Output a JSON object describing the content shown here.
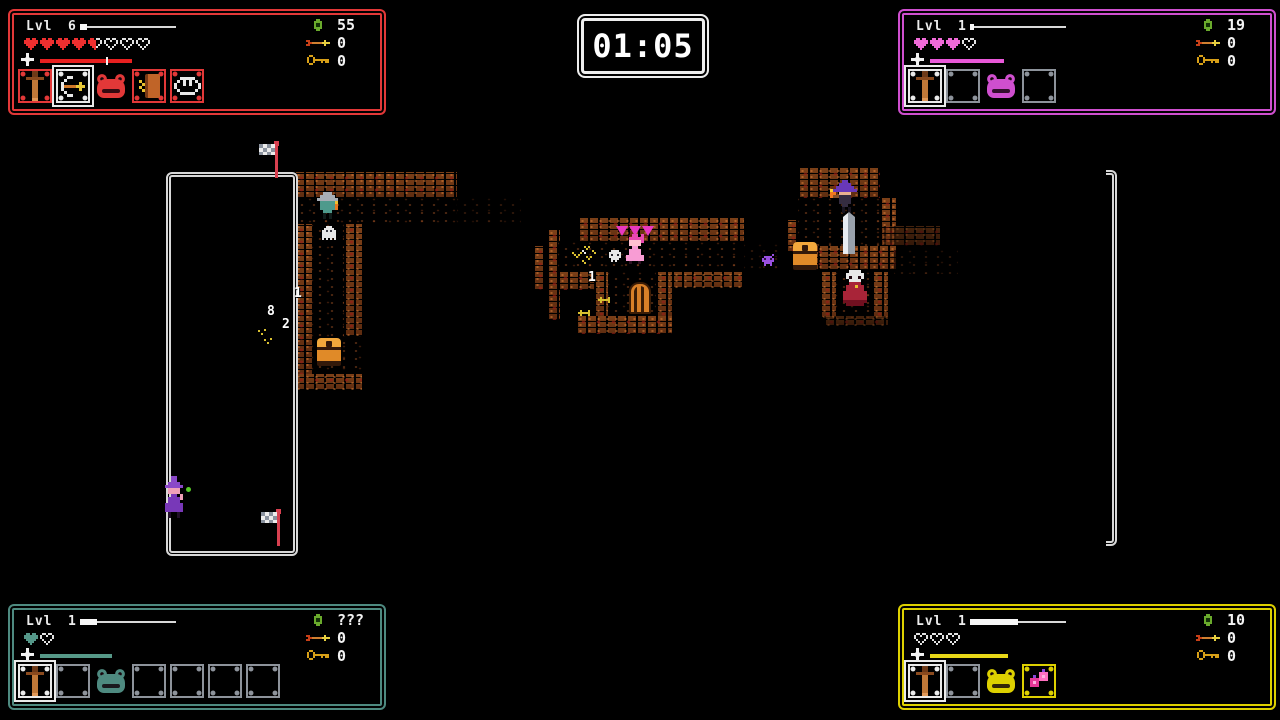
{
  "timer": {
    "value": "01:05"
  },
  "players": [
    {
      "position": "top-left",
      "colors": {
        "accent": "#e23838",
        "heart": "#ee2f2f",
        "bar": "#e82020"
      },
      "level_label": "Lvl",
      "level": "6",
      "xp_fill": 0.07,
      "hearts": [
        "full",
        "full",
        "full",
        "full",
        "half",
        "empty",
        "empty",
        "empty"
      ],
      "special": {
        "width": 92,
        "tick": 0.72
      },
      "counters": {
        "gems": "55",
        "arrows": "0",
        "keys": "0"
      },
      "slots": [
        {
          "item": "sword",
          "frame": "accent"
        },
        {
          "item": "bow",
          "frame": "selected"
        },
        {
          "item": "slime"
        },
        {
          "item": "book",
          "frame": "accent"
        },
        {
          "item": "fangs",
          "frame": "accent"
        }
      ]
    },
    {
      "position": "top-right",
      "colors": {
        "accent": "#cf4fcf",
        "heart": "#f06ad8",
        "bar": "#e858d8"
      },
      "level_label": "Lvl",
      "level": "1",
      "xp_fill": 0.02,
      "hearts": [
        "full",
        "full",
        "full",
        "empty"
      ],
      "special": {
        "width": 74,
        "tick": null
      },
      "counters": {
        "gems": "19",
        "arrows": "0",
        "keys": "0"
      },
      "slots": [
        {
          "item": "sword",
          "frame": "selected"
        },
        {
          "item": "none",
          "frame": "empty"
        },
        {
          "item": "slime"
        },
        {
          "item": "none",
          "frame": "empty"
        }
      ]
    },
    {
      "position": "bottom-left",
      "colors": {
        "accent": "#4e8a80",
        "heart": "#56988a",
        "bar": "#569888"
      },
      "level_label": "Lvl",
      "level": "1",
      "xp_fill": 0.18,
      "hearts": [
        "full",
        "empty"
      ],
      "special": {
        "width": 72,
        "tick": null
      },
      "counters": {
        "gems": "???",
        "arrows": "0",
        "keys": "0"
      },
      "slots": [
        {
          "item": "sword",
          "frame": "selected"
        },
        {
          "item": "none",
          "frame": "empty"
        },
        {
          "item": "slime"
        },
        {
          "item": "none",
          "frame": "empty"
        },
        {
          "item": "none",
          "frame": "empty"
        },
        {
          "item": "none",
          "frame": "empty"
        },
        {
          "item": "none",
          "frame": "empty"
        }
      ]
    },
    {
      "position": "bottom-right",
      "colors": {
        "accent": "#ddd000",
        "heart": "#e2e2e2",
        "bar": "#e8d818"
      },
      "level_label": "Lvl",
      "level": "1",
      "xp_fill": 0.5,
      "hearts": [
        "empty",
        "empty",
        "empty"
      ],
      "special": {
        "width": 78,
        "tick": null
      },
      "counters": {
        "gems": "10",
        "arrows": "0",
        "keys": "0"
      },
      "slots": [
        {
          "item": "sword",
          "frame": "selected"
        },
        {
          "item": "none",
          "frame": "empty"
        },
        {
          "item": "slime"
        },
        {
          "item": "berries",
          "frame": "accent"
        }
      ]
    }
  ],
  "map": {
    "room": {
      "x": 166,
      "y": 172,
      "w": 122,
      "h": 374
    },
    "right_wall": {
      "x": 1106,
      "y": 170,
      "w": 11,
      "h": 376
    },
    "tiles": [
      {
        "k": "brick",
        "x": 294,
        "y": 172,
        "w": 163,
        "h": 26
      },
      {
        "k": "floor",
        "x": 294,
        "y": 198,
        "w": 163,
        "h": 26
      },
      {
        "k": "floor2",
        "x": 457,
        "y": 198,
        "w": 64,
        "h": 26
      },
      {
        "k": "brick",
        "x": 294,
        "y": 224,
        "w": 18,
        "h": 152
      },
      {
        "k": "floor",
        "x": 312,
        "y": 224,
        "w": 50,
        "h": 150
      },
      {
        "k": "brick",
        "x": 344,
        "y": 224,
        "w": 18,
        "h": 112
      },
      {
        "k": "brick",
        "x": 294,
        "y": 374,
        "w": 68,
        "h": 16
      },
      {
        "k": "brick",
        "x": 533,
        "y": 246,
        "w": 11,
        "h": 44
      },
      {
        "k": "brick",
        "x": 547,
        "y": 230,
        "w": 13,
        "h": 90
      },
      {
        "k": "brick",
        "x": 578,
        "y": 218,
        "w": 166,
        "h": 24
      },
      {
        "k": "floor",
        "x": 558,
        "y": 242,
        "w": 186,
        "h": 30
      },
      {
        "k": "brick",
        "x": 558,
        "y": 272,
        "w": 52,
        "h": 18
      },
      {
        "k": "brick",
        "x": 594,
        "y": 272,
        "w": 14,
        "h": 46
      },
      {
        "k": "floor",
        "x": 608,
        "y": 272,
        "w": 48,
        "h": 46
      },
      {
        "k": "brick",
        "x": 656,
        "y": 272,
        "w": 16,
        "h": 46
      },
      {
        "k": "brick",
        "x": 672,
        "y": 272,
        "w": 72,
        "h": 16
      },
      {
        "k": "brick",
        "x": 576,
        "y": 316,
        "w": 96,
        "h": 18
      },
      {
        "k": "floor2",
        "x": 744,
        "y": 244,
        "w": 42,
        "h": 26
      },
      {
        "k": "brick",
        "x": 786,
        "y": 220,
        "w": 12,
        "h": 32
      },
      {
        "k": "brick",
        "x": 798,
        "y": 168,
        "w": 82,
        "h": 30
      },
      {
        "k": "floor",
        "x": 798,
        "y": 198,
        "w": 84,
        "h": 48
      },
      {
        "k": "brick",
        "x": 880,
        "y": 198,
        "w": 16,
        "h": 54
      },
      {
        "k": "brick",
        "x": 798,
        "y": 246,
        "w": 98,
        "h": 24
      },
      {
        "k": "brick2",
        "x": 884,
        "y": 226,
        "w": 56,
        "h": 20
      },
      {
        "k": "floor2",
        "x": 894,
        "y": 250,
        "w": 64,
        "h": 24
      },
      {
        "k": "brick",
        "x": 820,
        "y": 272,
        "w": 16,
        "h": 46
      },
      {
        "k": "floor",
        "x": 836,
        "y": 272,
        "w": 36,
        "h": 46
      },
      {
        "k": "brick",
        "x": 872,
        "y": 272,
        "w": 16,
        "h": 46
      },
      {
        "k": "brick2",
        "x": 824,
        "y": 316,
        "w": 64,
        "h": 10
      }
    ],
    "sprites": [
      {
        "t": "flag",
        "x": 275,
        "y": 142
      },
      {
        "t": "flag",
        "x": 277,
        "y": 510
      },
      {
        "t": "witchroom",
        "x": 162,
        "y": 476
      },
      {
        "t": "dotgreen",
        "x": 186,
        "y": 487
      },
      {
        "t": "gnome",
        "x": 317,
        "y": 192
      },
      {
        "t": "ghost",
        "x": 322,
        "y": 226
      },
      {
        "t": "chest",
        "x": 317,
        "y": 338
      },
      {
        "t": "spark",
        "x": 258,
        "y": 330
      },
      {
        "t": "spark",
        "x": 264,
        "y": 339
      },
      {
        "t": "tri",
        "x": 616,
        "y": 226
      },
      {
        "t": "tri",
        "x": 629,
        "y": 226
      },
      {
        "t": "tri",
        "x": 642,
        "y": 226
      },
      {
        "t": "princess",
        "x": 626,
        "y": 234
      },
      {
        "t": "skull",
        "x": 609,
        "y": 250
      },
      {
        "t": "bones",
        "x": 572,
        "y": 246
      },
      {
        "t": "arrowleft",
        "x": 598,
        "y": 295
      },
      {
        "t": "arrowleft",
        "x": 578,
        "y": 308
      },
      {
        "t": "door",
        "x": 629,
        "y": 282
      },
      {
        "t": "imp",
        "x": 762,
        "y": 254
      },
      {
        "t": "witchfire",
        "x": 830,
        "y": 180
      },
      {
        "t": "bigsword",
        "x": 843,
        "y": 212
      },
      {
        "t": "chest",
        "x": 793,
        "y": 242
      },
      {
        "t": "priest",
        "x": 843,
        "y": 270
      }
    ],
    "damage_numbers": [
      {
        "text": "1",
        "x": 294,
        "y": 286
      },
      {
        "text": "8",
        "x": 267,
        "y": 304
      },
      {
        "text": "2",
        "x": 282,
        "y": 317
      },
      {
        "text": "1",
        "x": 588,
        "y": 270
      }
    ]
  }
}
